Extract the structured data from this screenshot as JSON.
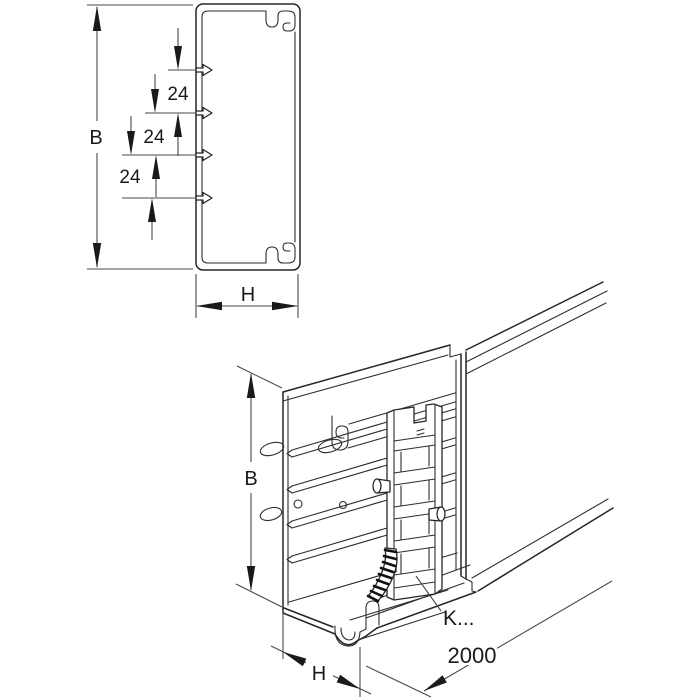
{
  "drawing_title": "Cable trunking dimensional drawing",
  "colors": {
    "background": "#ffffff",
    "object_line": "#262626",
    "dimension_line": "#4a4a4a",
    "arrow_fill": "#1a1a1a"
  },
  "view_cross_section": {
    "height_label": "B",
    "width_label": "H",
    "spacing_labels": [
      "24",
      "24",
      "24"
    ]
  },
  "view_perspective": {
    "height_label": "B",
    "width_label": "H",
    "length_label": "2000",
    "coupler_label": "K..."
  }
}
